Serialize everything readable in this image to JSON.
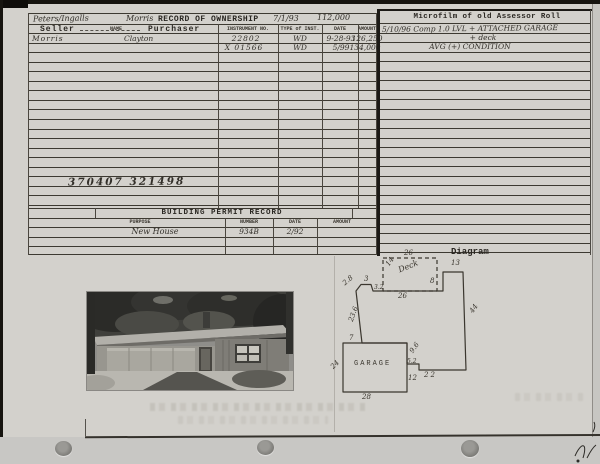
{
  "card": {
    "ownership": {
      "handwritten_names": "Peters/Ingalls",
      "handwritten_owner": "Morris",
      "title": "RECORD OF OWNERSHIP",
      "handwritten_date": "7/1/93",
      "handwritten_amount": "112,000",
      "headers": {
        "seller": "Seller",
        "name": "NAME",
        "purchaser": "Purchaser",
        "instrument_no": "INSTRUMENT NO.",
        "type_of_inst": "TYPE of INST.",
        "date": "DATE",
        "amount": "AMOUNT"
      },
      "rows": [
        {
          "seller": "Morris",
          "purchaser": "Clayton",
          "instrument_no": "22802",
          "type": "WD",
          "date": "9-28-93",
          "amount": "126,250"
        },
        {
          "seller": "",
          "purchaser": "",
          "instrument_no": "X 01566",
          "type": "WD",
          "date": "5/99",
          "amount": "134,000"
        }
      ],
      "handwritten_parcel_numbers": "370407  321498"
    },
    "microfilm": {
      "title": "Microfilm of old Assessor Roll",
      "note_line1": "5/10/96   Comp 1.0 LVL + ATTACHED GARAGE",
      "note_line2": "+ deck",
      "note_line3": "AVG (+) CONDITION"
    },
    "building_permit": {
      "title": "BUILDING PERMIT RECORD",
      "headers": {
        "purpose": "PURPOSE",
        "number": "NUMBER",
        "date": "DATE",
        "amount": "AMOUNT"
      },
      "rows": [
        {
          "purpose": "New House",
          "number": "934B",
          "date": "2/92",
          "amount": ""
        }
      ]
    },
    "diagram": {
      "title": "Diagram",
      "deck_label": "Deck",
      "garage_label": "GARAGE",
      "dimensions": {
        "deck_top": "26",
        "deck_left": "14",
        "top_left_diag": "2.8",
        "top_small": "3",
        "top_step": "3.2",
        "top_wall": "26",
        "right_step_up": "8",
        "top_right": "13",
        "right_wall": "44",
        "bottom_wall": "22",
        "bottom_step": "5.2",
        "garage_right_upper": "9.6",
        "garage_right_lower": "12",
        "garage_top": "7",
        "garage_left": "24",
        "garage_bottom": "28",
        "left_wall": "23.6"
      }
    }
  }
}
